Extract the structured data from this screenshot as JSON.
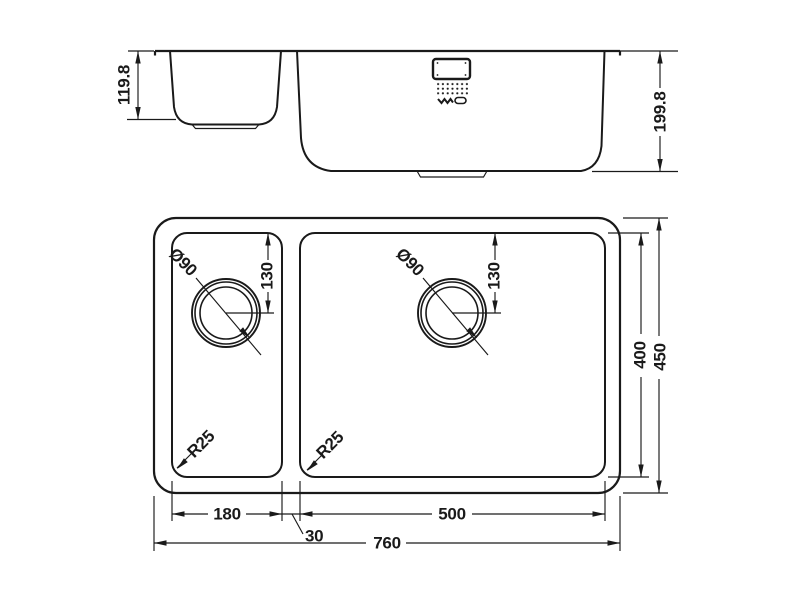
{
  "drawing": {
    "type": "technical-drawing",
    "subject": "double-bowl-undermount-sink",
    "colors": {
      "line": "#1a1a1a",
      "background": "#ffffff"
    },
    "elevation": {
      "depth_small": "119.8",
      "depth_large": "199.8"
    },
    "plan": {
      "drain_dia_small": "Ø90",
      "drain_dia_large": "Ø90",
      "drain_offset_small": "130",
      "drain_offset_large": "130",
      "radius_small": "R25",
      "radius_large": "R25",
      "bowl_inner_height": "400",
      "overall_height": "450",
      "small_bowl_width": "180",
      "divider_width": "30",
      "large_bowl_width": "500",
      "overall_width": "760"
    }
  }
}
